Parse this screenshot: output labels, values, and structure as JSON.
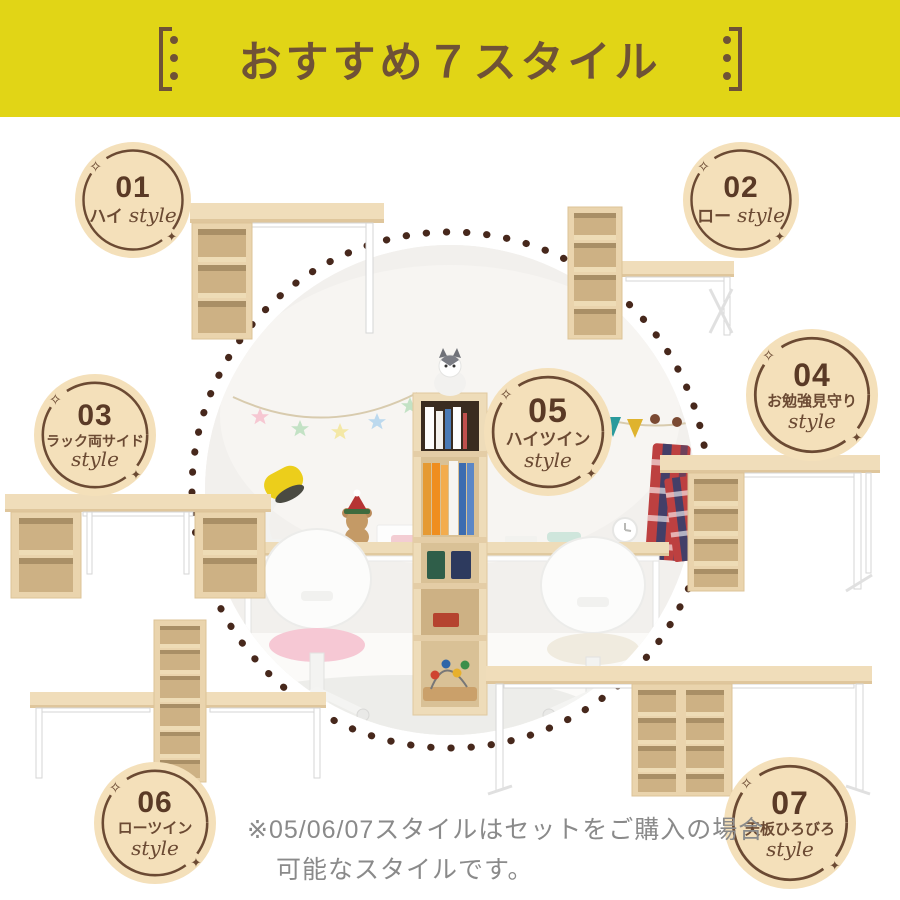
{
  "header": {
    "title": "おすすめ７スタイル"
  },
  "badges": [
    {
      "number": "01",
      "jp": "ハイ",
      "style_word": "style"
    },
    {
      "number": "02",
      "jp": "ロー",
      "style_word": "style"
    },
    {
      "number": "03",
      "jp": "ラック両サイド",
      "style_word": "style"
    },
    {
      "number": "04",
      "jp": "お勉強見守り",
      "style_word": "style"
    },
    {
      "number": "05",
      "jp": "ハイツイン",
      "style_word": "style"
    },
    {
      "number": "06",
      "jp": "ローツイン",
      "style_word": "style"
    },
    {
      "number": "07",
      "jp": "天板ひろびろ",
      "style_word": "style"
    }
  ],
  "note": {
    "line1": "※05/06/07スタイルはセットをご購入の場合",
    "line2": "可能なスタイルです。"
  },
  "decor": {
    "sparkle_tl": "✧",
    "sparkle_br": "✦"
  },
  "colors": {
    "header_bg": "#e1d516",
    "header_text": "#6f5236",
    "badge_bg": "#f4e0ba",
    "badge_ring": "#6b4a33",
    "badge_number": "#5a3a26",
    "dot_ring": "#47281c",
    "note_text": "#8a8a8a",
    "wood": "#f0ddba",
    "wood_inner": "#cdb184",
    "leg_white": "#ffffff"
  }
}
